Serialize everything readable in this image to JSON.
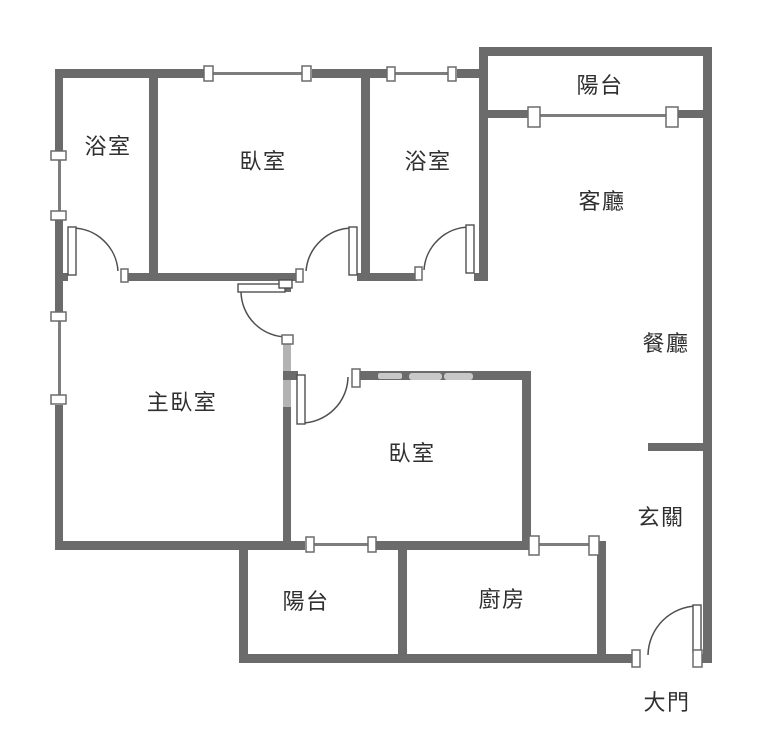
{
  "rooms": {
    "bathroom_top_left": {
      "label": "浴室"
    },
    "bedroom_top": {
      "label": "臥室"
    },
    "bathroom_top_right": {
      "label": "浴室"
    },
    "balcony_top": {
      "label": "陽台"
    },
    "living_room": {
      "label": "客廳"
    },
    "dining_room": {
      "label": "餐廳"
    },
    "master_bedroom": {
      "label": "主臥室"
    },
    "bedroom_middle": {
      "label": "臥室"
    },
    "entryway": {
      "label": "玄關"
    },
    "kitchen": {
      "label": "廚房"
    },
    "balcony_bottom": {
      "label": "陽台"
    },
    "main_door": {
      "label": "大門"
    }
  },
  "colors": {
    "wall": "#6b6b6b",
    "wall_light": "#b3b3b3",
    "furniture": "#c8c8c8",
    "door_line": "#4f4f4f",
    "window_line": "#7d7d7d",
    "text": "#2f2f2f",
    "background": "#ffffff"
  }
}
